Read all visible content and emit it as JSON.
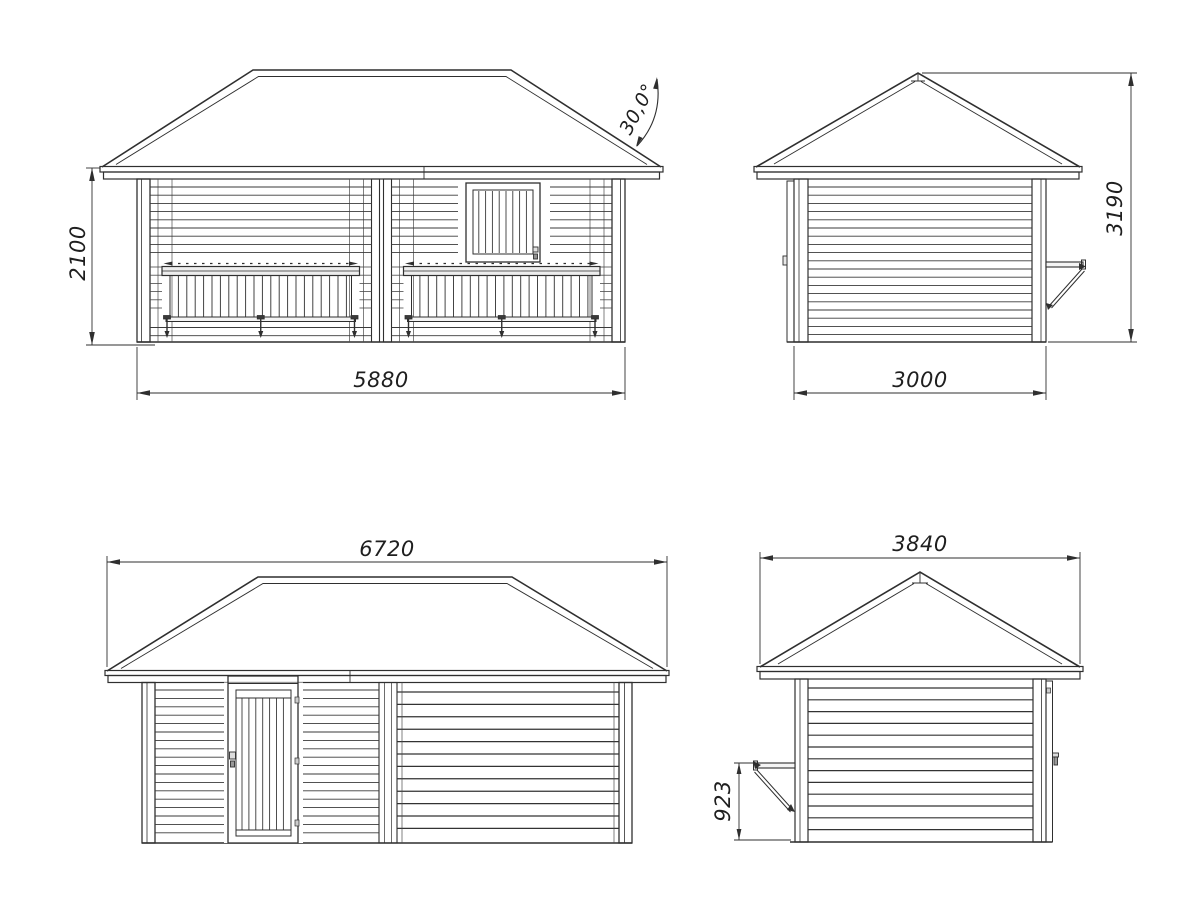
{
  "drawing": {
    "front_view": {
      "height_mm": "2100",
      "width_mm": "5880",
      "roof_angle": "30,0°"
    },
    "side_view_a": {
      "width_mm": "3000",
      "height_mm": "3190"
    },
    "rear_view": {
      "roof_width_mm": "6720"
    },
    "side_view_b": {
      "roof_width_mm": "3840",
      "flap_height_mm": "923"
    },
    "colors": {
      "line": "#2f2f2f",
      "background": "#ffffff"
    }
  }
}
